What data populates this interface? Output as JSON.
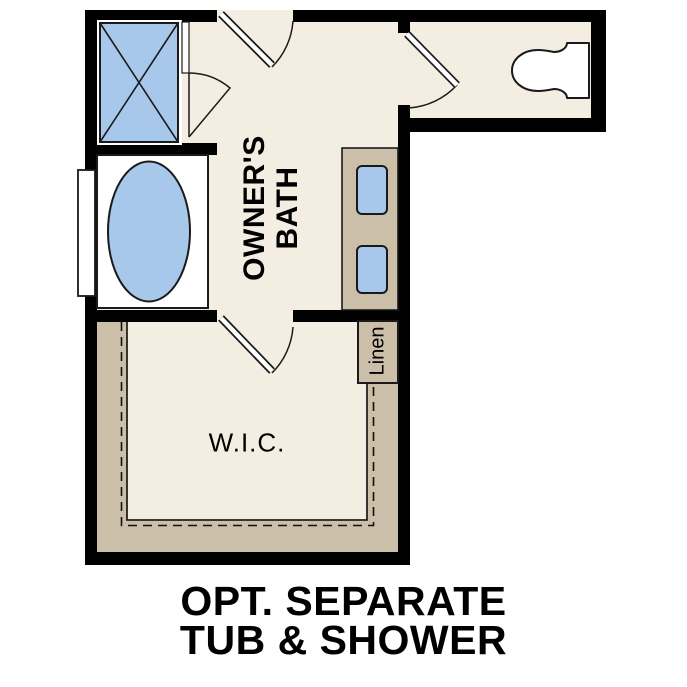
{
  "title": {
    "line1": "OPT. SEPARATE",
    "line2": "TUB & SHOWER"
  },
  "rooms": {
    "owners_bath": {
      "label_line1": "OWNER'S",
      "label_line2": "BATH"
    },
    "wic": {
      "label": "W.I.C."
    },
    "linen": {
      "label": "Linen"
    }
  },
  "fixtures": [
    "shower",
    "bathtub",
    "toilet",
    "vanity-with-two-sinks",
    "window",
    "linen-closet"
  ],
  "colors": {
    "floor": "#f4eee2",
    "casework": "#cbbfa9",
    "fixture_fill": "#a7c8ea",
    "wall": "#000000",
    "text": "#000000",
    "background": "#ffffff"
  }
}
